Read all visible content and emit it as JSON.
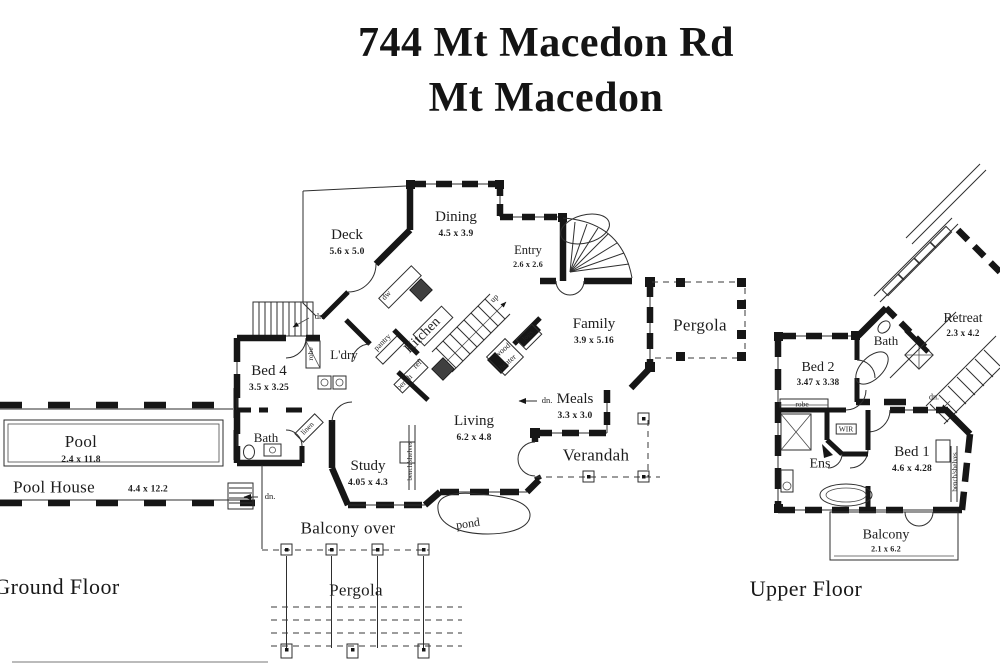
{
  "colors": {
    "ink": "#161616",
    "paper": "#ffffff"
  },
  "title": {
    "line1": "744 Mt Macedon Rd",
    "line2": "Mt Macedon"
  },
  "ground_floor": {
    "label": "Ground Floor",
    "rooms": {
      "deck": {
        "name": "Deck",
        "dims": "5.6 x 5.0"
      },
      "dining": {
        "name": "Dining",
        "dims": "4.5 x 3.9"
      },
      "entry": {
        "name": "Entry",
        "dims": "2.6 x 2.6"
      },
      "family": {
        "name": "Family",
        "dims": "3.9 x 5.16"
      },
      "pergola_east": {
        "name": "Pergola"
      },
      "bed4": {
        "name": "Bed 4",
        "dims": "3.5 x 3.25"
      },
      "ldry": {
        "name": "L'dry"
      },
      "kitchen": {
        "name": "Kitchen"
      },
      "meals": {
        "name": "Meals",
        "dims": "3.3 x 3.0"
      },
      "living": {
        "name": "Living",
        "dims": "6.2 x 4.8"
      },
      "study": {
        "name": "Study",
        "dims": "4.05 x 4.3"
      },
      "verandah": {
        "name": "Verandah"
      },
      "bath": {
        "name": "Bath"
      },
      "pool": {
        "name": "Pool",
        "dims": "2.4 x 11.8"
      },
      "pool_house": {
        "name": "Pool House",
        "dims": "4.4 x 12.2"
      },
      "balcony_over": {
        "name": "Balcony over"
      },
      "pond": {
        "name": "pond"
      },
      "pergola_south": {
        "name": "Pergola"
      }
    },
    "annotations": {
      "dn_stairs_nw": "dn.",
      "up_stairs": "up",
      "dw": "dw",
      "pantry": "pantry",
      "robe": "robe",
      "bench": "bench",
      "ref": "ref",
      "wood_heater_line1": "wood",
      "wood_heater_line2": "heater",
      "logs": "logs",
      "linen": "linen",
      "dn_pool_house": "dn.",
      "dn_meals": "dn.",
      "bench_shelves": "bench/shelves"
    }
  },
  "upper_floor": {
    "label": "Upper Floor",
    "rooms": {
      "bed2": {
        "name": "Bed 2",
        "dims": "3.47 x 3.38"
      },
      "bath": {
        "name": "Bath"
      },
      "retreat": {
        "name": "Retreat",
        "dims": "2.3 x 4.2"
      },
      "bed1": {
        "name": "Bed 1",
        "dims": "4.6 x 4.28"
      },
      "ens": {
        "name": "Ens"
      },
      "wir": {
        "name": "WIR"
      },
      "balcony": {
        "name": "Balcony",
        "dims": "2.1 x 6.2"
      }
    },
    "annotations": {
      "robe": "robe",
      "dn_stairs": "dn.",
      "bench_shelves": "bench/shelves"
    }
  }
}
